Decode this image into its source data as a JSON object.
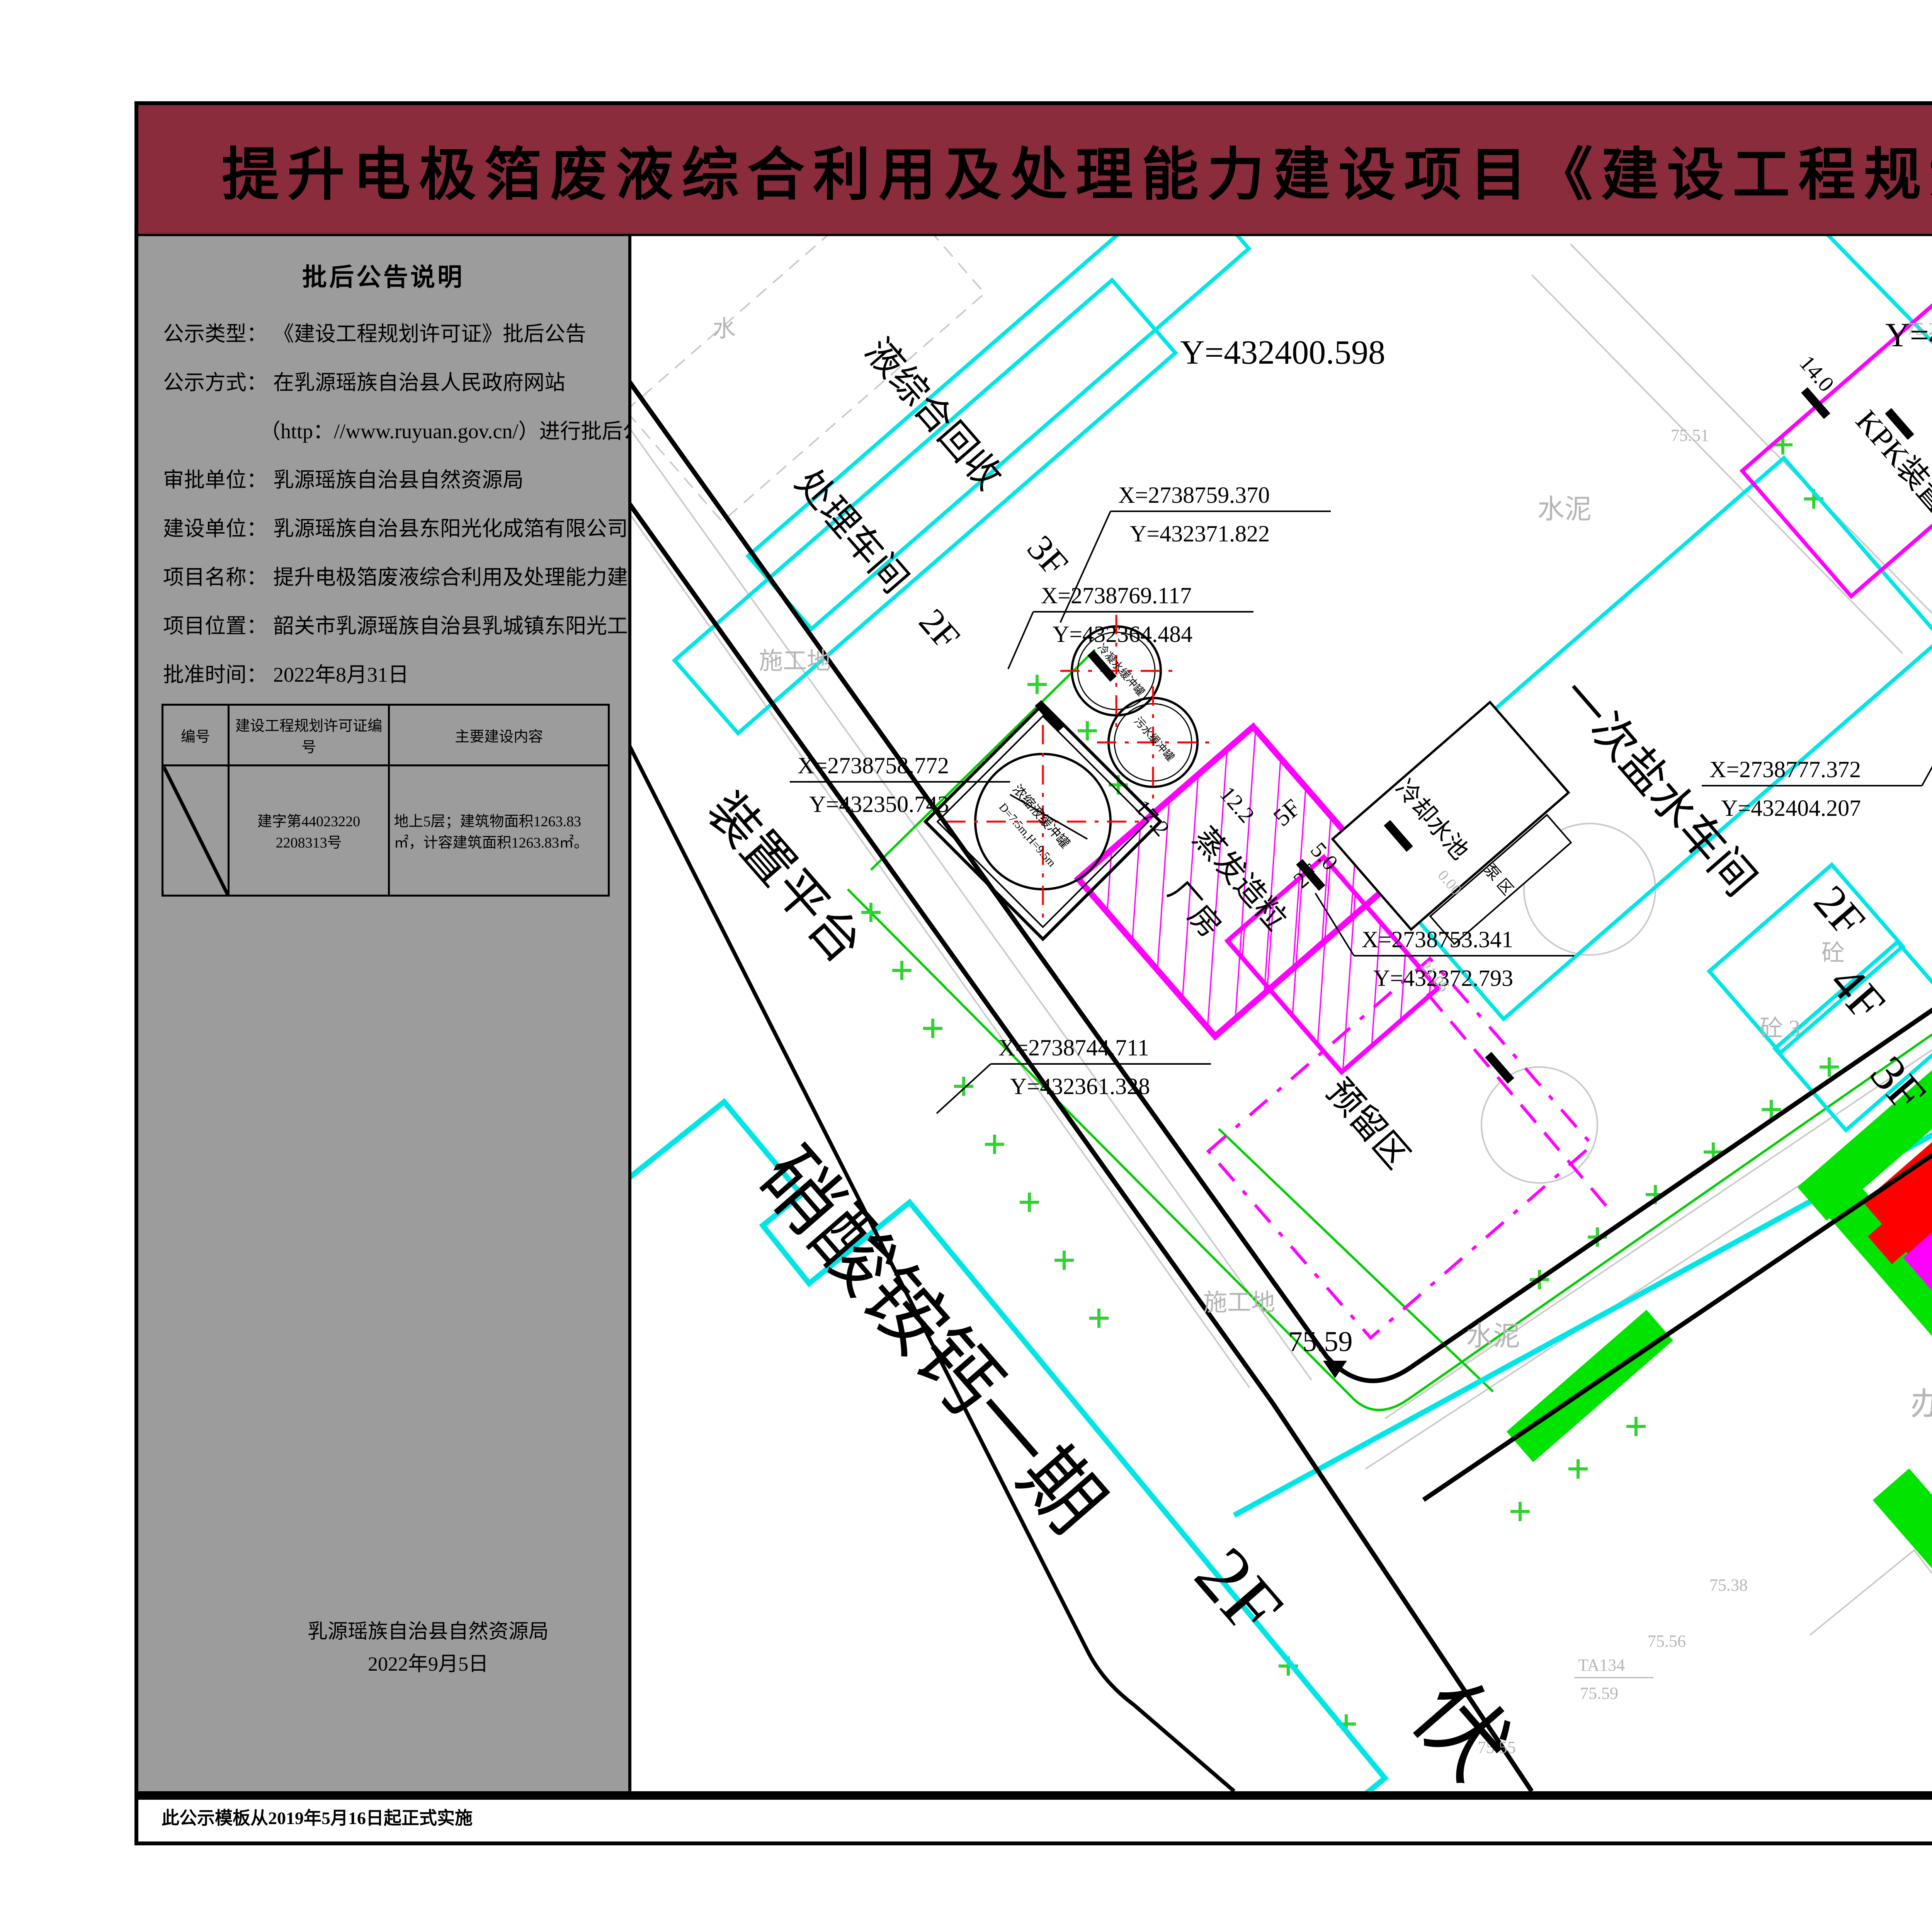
{
  "title": "提升电极箔废液综合利用及处理能力建设项目《建设工程规划许可证》批后公告",
  "sidebar": {
    "heading": "批后公告说明",
    "fields": [
      {
        "label": "公示类型：",
        "value": "《建设工程规划许可证》批后公告"
      },
      {
        "label": "公示方式：",
        "value": "在乳源瑶族自治县人民政府网站"
      },
      {
        "label": "",
        "value": "（http：//www.ruyuan.gov.cn/）进行批后公告"
      },
      {
        "label": "审批单位：",
        "value": "乳源瑶族自治县自然资源局"
      },
      {
        "label": "建设单位：",
        "value": "乳源瑶族自治县东阳光化成箔有限公司"
      },
      {
        "label": "项目名称：",
        "value": "提升电极箔废液综合利用及处理能力建设项目"
      },
      {
        "label": "项目位置：",
        "value": "韶关市乳源瑶族自治县乳城镇东阳光工业园"
      },
      {
        "label": "批准时间：",
        "value": "2022年8月31日"
      }
    ],
    "table": {
      "headers": [
        "编号",
        "建设工程规划许可证编号",
        "主要建设内容"
      ],
      "row": {
        "no": "",
        "permit": "建字第44023220 2208313号",
        "content": "地上5层；建筑物面积1263.83㎡，计容建筑面积1263.83㎡。"
      }
    },
    "issuer": "乳源瑶族自治县自然资源局",
    "issue_date": "2022年9月5日"
  },
  "compass": {
    "north": "N"
  },
  "legend": {
    "header": "图 例",
    "items": [
      "总用地红线",
      "规划建设用地红线",
      "建筑控制线",
      "本次公告建筑",
      "规划建筑",
      "现状建筑",
      "道路",
      "坐标标注",
      "尺寸标注",
      "道路标高",
      "绿化"
    ],
    "sample": {
      "coord_x": "X=2738345.676",
      "coord_y": "Y=431946.915",
      "dim": "20",
      "elev": "75.24",
      "floor": "2F"
    }
  },
  "location": {
    "header": "项目位置示意",
    "marker_label": "项目位置",
    "road_label": "瑞临线",
    "company_line1": "乳源东阳光化成",
    "company_line2": "箔有限公司"
  },
  "map": {
    "y_grid": "Y=432400.598",
    "y_grid_partial": "Y=4",
    "coords": [
      {
        "x": "X=2738759.370",
        "y": "Y=432371.822"
      },
      {
        "x": "X=2738769.117",
        "y": "Y=432364.484"
      },
      {
        "x": "X=2738758.772",
        "y": "Y=432350.743"
      },
      {
        "x": "X=2738777.372",
        "y": "Y=432404.207"
      },
      {
        "x": "X=2738753.341",
        "y": "Y=432372.793"
      },
      {
        "x": "X=2738744.711",
        "y": "Y=432361.328"
      }
    ],
    "buildings": {
      "recycle": "液综合回收",
      "recycle_floor": "3F",
      "treat": "处理车间",
      "treat_floor": "2F",
      "brine": "一次盐水车间",
      "brine_f1": "2F",
      "brine_f2": "4F",
      "brine_f3": "3F",
      "kpk": "KPK装置区",
      "acid1": "稀酸含氮",
      "acid2": "水中和",
      "emergency": "应急池",
      "evap1": "蒸发造粒",
      "evap2": "厂房",
      "evap_floor": "5F",
      "evap_annex_floor": "2F",
      "cooling": "冷却水池",
      "pump": "泵 区",
      "reserved": "预留区",
      "can_phase1": "硝酸铵钙一期",
      "can_floor": "2F",
      "partial_char": "伏",
      "platform": "装置平台",
      "tank1": "浓缩液缓冲罐",
      "tank1_spec": "D=7.5m,H=9.5m",
      "tank2": "冷凝水缓冲罐",
      "tank3": "污水缓冲罐"
    },
    "dims": {
      "d14a": "14.0",
      "d14b": "14.0",
      "d14c": "14.0",
      "d12": "12.0",
      "d24": "24.0",
      "d17": "17.2",
      "d12_2": "12.2",
      "d5": "5.0",
      "d0": "0.00",
      "d21": "21.06"
    },
    "elev": {
      "road": "75.59",
      "e75_51": "75.51",
      "e75_26": "75.26",
      "e75_38": "75.38",
      "e75_56": "75.56",
      "e75_55": "75.55",
      "e75_62": "75.62",
      "e75_52": "75.52",
      "ta133": "TA133",
      "ta133_v": "75.54",
      "ta133b": "TA133",
      "ta134": "TA134",
      "ta134_v": "75.59"
    },
    "gray": {
      "cement1": "水泥",
      "cement2": "水泥",
      "site1": "施工地",
      "site2": "施工地",
      "conc1": "砼",
      "conc2": "砼 3",
      "build": "建",
      "office": "办",
      "water": "水"
    }
  },
  "footer": {
    "left": "此公示模板从2019年5月16日起正式实施",
    "right": "监制单位：乳源瑶族自治县自然资源局"
  },
  "colors": {
    "banner": "#8B2C3C",
    "sidebar": "#9C9C9C",
    "red_line": "#FF0000",
    "plan_line": "#FF00FF",
    "control_line": "#00DD00",
    "existing": "#00E5E5",
    "greenery": "#00E400",
    "announce_red": "#E60000"
  }
}
